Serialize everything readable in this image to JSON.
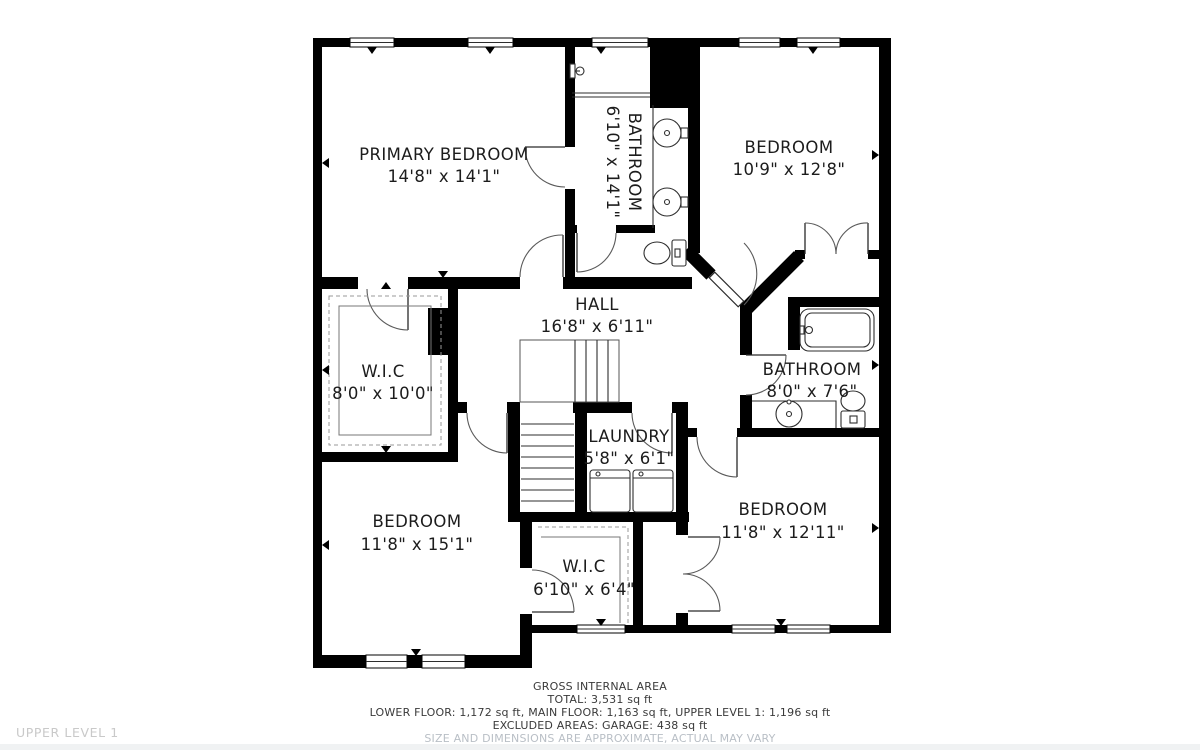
{
  "floor_label": "UPPER LEVEL 1",
  "rooms": [
    {
      "id": "primary-bedroom",
      "name": "PRIMARY BEDROOM",
      "dims": "14'8\" x 14'1\""
    },
    {
      "id": "bathroom-ensuite",
      "name": "BATHROOM",
      "dims": "6'10\" x 14'1\""
    },
    {
      "id": "bedroom-top-right",
      "name": "BEDROOM",
      "dims": "10'9\" x 12'8\""
    },
    {
      "id": "hall",
      "name": "HALL",
      "dims": "16'8\" x 6'11\""
    },
    {
      "id": "wic-left",
      "name": "W.I.C",
      "dims": "8'0\" x 10'0\""
    },
    {
      "id": "bathroom-right",
      "name": "BATHROOM",
      "dims": "8'0\" x 7'6\""
    },
    {
      "id": "laundry",
      "name": "LAUNDRY",
      "dims": "5'8\" x 6'1\""
    },
    {
      "id": "bedroom-bottom-left",
      "name": "BEDROOM",
      "dims": "11'8\" x 15'1\""
    },
    {
      "id": "wic-bottom",
      "name": "W.I.C",
      "dims": "6'10\" x 6'4\""
    },
    {
      "id": "bedroom-bottom-right",
      "name": "BEDROOM",
      "dims": "11'8\" x 12'11\""
    }
  ],
  "footer": {
    "title": "GROSS INTERNAL AREA",
    "total": "TOTAL: 3,531 sq ft",
    "floors": "LOWER FLOOR: 1,172 sq ft, MAIN FLOOR: 1,163 sq ft, UPPER LEVEL 1: 1,196 sq ft",
    "excluded": "EXCLUDED AREAS: GARAGE: 438 sq ft",
    "disclaimer": "SIZE AND DIMENSIONS ARE APPROXIMATE, ACTUAL MAY VARY"
  },
  "colors": {
    "wall": "#000000",
    "label_text": "#1c1c1c",
    "floor_label_text": "#c9c9c9",
    "disclaimer_text": "#b9bfc6",
    "background": "#ffffff",
    "bottom_bar": "#f0f2f3"
  }
}
